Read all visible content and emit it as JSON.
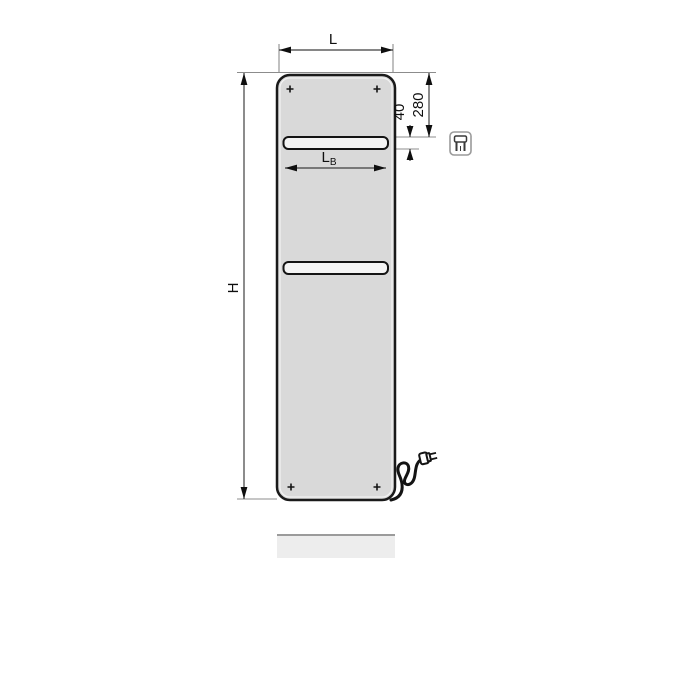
{
  "diagram": {
    "kind": "technical-dimension-drawing",
    "labels": {
      "overall_width": "L",
      "overall_height": "H",
      "rail_width_main": "L",
      "rail_width_sub": "B",
      "top_to_rail": "280",
      "rail_height": "40"
    },
    "icons": {
      "corner_icon": "electric-plug-icon"
    },
    "colors": {
      "background": "#ffffff",
      "panel_fill": "#d9d9d9",
      "panel_outline": "#1a1a1a",
      "rail_fill": "#f4f4f4",
      "dimension_line": "#3f3f3f",
      "extension_line": "#8c8c8c",
      "label_text": "#0f0f0f",
      "floor_shadow_fill": "#ededed",
      "floor_shadow_edge": "#9b9b9b"
    }
  }
}
